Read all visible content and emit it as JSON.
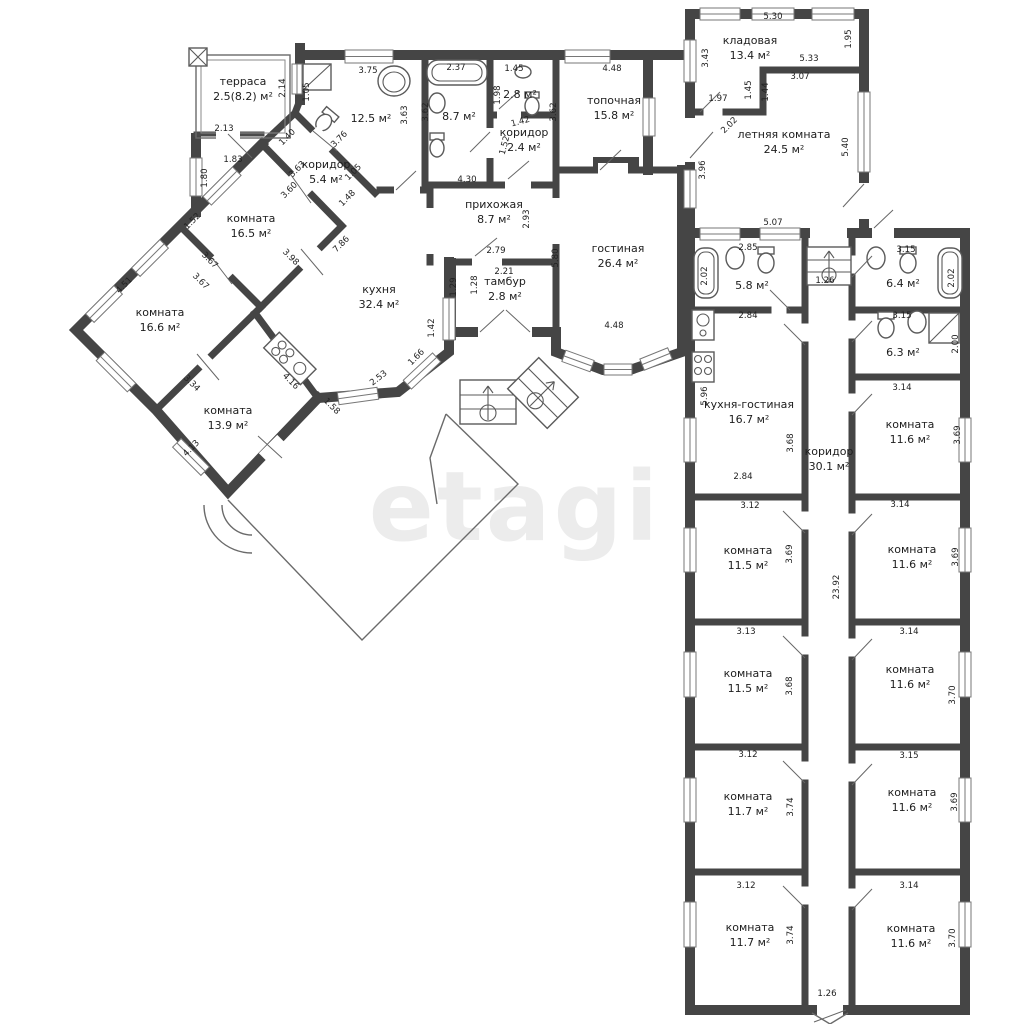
{
  "watermark": "etagi",
  "colors": {
    "wall": "#454545",
    "text": "#1d1d1d",
    "dimension_text": "#222222",
    "watermark": "#ececec",
    "background": "#ffffff"
  },
  "area_unit": "м²",
  "rooms": [
    {
      "name": "терраса",
      "area": "2.5(8.2) м²",
      "x": 243,
      "y": 85
    },
    {
      "name": "коридор",
      "area": "5.4 м²",
      "x": 326,
      "y": 168
    },
    {
      "name": "",
      "area": "12.5 м²",
      "x": 371,
      "y": 116
    },
    {
      "name": "",
      "area": "8.7 м²",
      "x": 459,
      "y": 114
    },
    {
      "name": "",
      "area": "2.8 м²",
      "x": 520,
      "y": 92
    },
    {
      "name": "коридор",
      "area": "2.4 м²",
      "x": 524,
      "y": 136
    },
    {
      "name": "топочная",
      "area": "15.8 м²",
      "x": 614,
      "y": 104
    },
    {
      "name": "прихожая",
      "area": "8.7 м²",
      "x": 494,
      "y": 208
    },
    {
      "name": "тамбур",
      "area": "2.8 м²",
      "x": 505,
      "y": 285
    },
    {
      "name": "гостиная",
      "area": "26.4 м²",
      "x": 618,
      "y": 252
    },
    {
      "name": "кухня",
      "area": "32.4 м²",
      "x": 379,
      "y": 293
    },
    {
      "name": "комната",
      "area": "16.5 м²",
      "x": 251,
      "y": 222
    },
    {
      "name": "комната",
      "area": "16.6 м²",
      "x": 160,
      "y": 316
    },
    {
      "name": "комната",
      "area": "13.9 м²",
      "x": 228,
      "y": 414
    },
    {
      "name": "кладовая",
      "area": "13.4 м²",
      "x": 750,
      "y": 44
    },
    {
      "name": "летняя комната",
      "area": "24.5 м²",
      "x": 784,
      "y": 138
    },
    {
      "name": "",
      "area": "5.8 м²",
      "x": 752,
      "y": 283
    },
    {
      "name": "",
      "area": "6.4 м²",
      "x": 903,
      "y": 281
    },
    {
      "name": "",
      "area": "6.3 м²",
      "x": 903,
      "y": 350
    },
    {
      "name": "кухня-гостиная",
      "area": "16.7 м²",
      "x": 749,
      "y": 408
    },
    {
      "name": "коридор",
      "area": "30.1 м²",
      "x": 829,
      "y": 455
    },
    {
      "name": "комната",
      "area": "11.6 м²",
      "x": 910,
      "y": 428
    },
    {
      "name": "комната",
      "area": "11.5 м²",
      "x": 748,
      "y": 554
    },
    {
      "name": "комната",
      "area": "11.6 м²",
      "x": 912,
      "y": 553
    },
    {
      "name": "комната",
      "area": "11.5 м²",
      "x": 748,
      "y": 677
    },
    {
      "name": "комната",
      "area": "11.6 м²",
      "x": 910,
      "y": 673
    },
    {
      "name": "комната",
      "area": "11.7 м²",
      "x": 748,
      "y": 800
    },
    {
      "name": "комната",
      "area": "11.6 м²",
      "x": 912,
      "y": 796
    },
    {
      "name": "комната",
      "area": "11.7 м²",
      "x": 750,
      "y": 931
    },
    {
      "name": "комната",
      "area": "11.6 м²",
      "x": 911,
      "y": 932
    }
  ],
  "dimensions": [
    {
      "v": "2.13",
      "x": 224,
      "y": 131,
      "r": 0
    },
    {
      "v": "1.83",
      "x": 233,
      "y": 162,
      "r": 0
    },
    {
      "v": "1.80",
      "x": 207,
      "y": 178,
      "r": -90
    },
    {
      "v": "2.14",
      "x": 285,
      "y": 88,
      "r": -90
    },
    {
      "v": "1.05",
      "x": 309,
      "y": 92,
      "r": -90
    },
    {
      "v": "3.75",
      "x": 368,
      "y": 73,
      "r": 0
    },
    {
      "v": "2.37",
      "x": 456,
      "y": 70,
      "r": 0
    },
    {
      "v": "1.45",
      "x": 514,
      "y": 71,
      "r": 0
    },
    {
      "v": "1.98",
      "x": 500,
      "y": 95,
      "r": -90
    },
    {
      "v": "3.63",
      "x": 407,
      "y": 115,
      "r": -90
    },
    {
      "v": "3.62",
      "x": 428,
      "y": 112,
      "r": -90
    },
    {
      "v": "3.62",
      "x": 556,
      "y": 112,
      "r": -90
    },
    {
      "v": "1.42",
      "x": 521,
      "y": 124,
      "r": -15
    },
    {
      "v": "1.52",
      "x": 507,
      "y": 146,
      "r": -75
    },
    {
      "v": "4.48",
      "x": 612,
      "y": 71,
      "r": 0
    },
    {
      "v": "4.30",
      "x": 467,
      "y": 182,
      "r": 0
    },
    {
      "v": "2.93",
      "x": 529,
      "y": 219,
      "r": -90
    },
    {
      "v": "5.80",
      "x": 558,
      "y": 258,
      "r": -90
    },
    {
      "v": "4.48",
      "x": 614,
      "y": 328,
      "r": 0
    },
    {
      "v": "2.79",
      "x": 496,
      "y": 253,
      "r": 0
    },
    {
      "v": "2.21",
      "x": 504,
      "y": 274,
      "r": 0
    },
    {
      "v": "1.29",
      "x": 456,
      "y": 287,
      "r": -90
    },
    {
      "v": "1.28",
      "x": 477,
      "y": 285,
      "r": -90
    },
    {
      "v": "1.42",
      "x": 434,
      "y": 328,
      "r": -90
    },
    {
      "v": "1.66",
      "x": 418,
      "y": 359,
      "r": -45
    },
    {
      "v": "2.53",
      "x": 380,
      "y": 380,
      "r": -38
    },
    {
      "v": "7.86",
      "x": 343,
      "y": 246,
      "r": -45
    },
    {
      "v": "1.48",
      "x": 349,
      "y": 200,
      "r": -45
    },
    {
      "v": "1.40",
      "x": 289,
      "y": 139,
      "r": -45
    },
    {
      "v": "3.63",
      "x": 299,
      "y": 171,
      "r": -45
    },
    {
      "v": "3.60",
      "x": 291,
      "y": 192,
      "r": -45
    },
    {
      "v": "3.76",
      "x": 341,
      "y": 141,
      "r": -45
    },
    {
      "v": "1.05",
      "x": 355,
      "y": 174,
      "r": -45
    },
    {
      "v": "1.52",
      "x": 194,
      "y": 223,
      "r": -45
    },
    {
      "v": "4.51",
      "x": 126,
      "y": 287,
      "r": -45
    },
    {
      "v": "3.67",
      "x": 208,
      "y": 262,
      "r": 45
    },
    {
      "v": "3.67",
      "x": 199,
      "y": 283,
      "r": 45
    },
    {
      "v": "3.98",
      "x": 289,
      "y": 259,
      "r": 45
    },
    {
      "v": "3.34",
      "x": 190,
      "y": 385,
      "r": 45
    },
    {
      "v": "4.13",
      "x": 193,
      "y": 450,
      "r": -45
    },
    {
      "v": "4.16",
      "x": 289,
      "y": 383,
      "r": 45
    },
    {
      "v": "1.58",
      "x": 330,
      "y": 408,
      "r": 45
    },
    {
      "v": "5.30",
      "x": 773,
      "y": 19,
      "r": 0
    },
    {
      "v": "1.95",
      "x": 851,
      "y": 39,
      "r": -90
    },
    {
      "v": "3.43",
      "x": 708,
      "y": 58,
      "r": -90
    },
    {
      "v": "5.33",
      "x": 809,
      "y": 61,
      "r": 0
    },
    {
      "v": "3.07",
      "x": 800,
      "y": 79,
      "r": 0
    },
    {
      "v": "1.45",
      "x": 751,
      "y": 90,
      "r": -90
    },
    {
      "v": "1.44",
      "x": 768,
      "y": 92,
      "r": -90
    },
    {
      "v": "1.97",
      "x": 718,
      "y": 101,
      "r": 0
    },
    {
      "v": "2.02",
      "x": 731,
      "y": 127,
      "r": -45
    },
    {
      "v": "5.40",
      "x": 848,
      "y": 147,
      "r": -90
    },
    {
      "v": "3.96",
      "x": 705,
      "y": 170,
      "r": -90
    },
    {
      "v": "5.07",
      "x": 773,
      "y": 225,
      "r": 0
    },
    {
      "v": "2.85",
      "x": 748,
      "y": 250,
      "r": 0
    },
    {
      "v": "2.02",
      "x": 707,
      "y": 276,
      "r": -90
    },
    {
      "v": "3.15",
      "x": 906,
      "y": 252,
      "r": 0
    },
    {
      "v": "2.02",
      "x": 954,
      "y": 278,
      "r": -90
    },
    {
      "v": "1.26",
      "x": 825,
      "y": 283,
      "r": 0
    },
    {
      "v": "2.84",
      "x": 748,
      "y": 318,
      "r": 0
    },
    {
      "v": "3.15",
      "x": 902,
      "y": 318,
      "r": 0
    },
    {
      "v": "2.00",
      "x": 958,
      "y": 344,
      "r": -90
    },
    {
      "v": "5.96",
      "x": 707,
      "y": 396,
      "r": -90
    },
    {
      "v": "3.68",
      "x": 793,
      "y": 443,
      "r": -90
    },
    {
      "v": "2.84",
      "x": 743,
      "y": 479,
      "r": 0
    },
    {
      "v": "3.14",
      "x": 902,
      "y": 390,
      "r": 0
    },
    {
      "v": "3.69",
      "x": 960,
      "y": 435,
      "r": -90
    },
    {
      "v": "3.12",
      "x": 750,
      "y": 508,
      "r": 0
    },
    {
      "v": "3.69",
      "x": 792,
      "y": 554,
      "r": -90
    },
    {
      "v": "3.14",
      "x": 900,
      "y": 507,
      "r": 0
    },
    {
      "v": "3.69",
      "x": 958,
      "y": 557,
      "r": -90
    },
    {
      "v": "23.92",
      "x": 839,
      "y": 587,
      "r": -90
    },
    {
      "v": "3.13",
      "x": 746,
      "y": 634,
      "r": 0
    },
    {
      "v": "3.68",
      "x": 792,
      "y": 686,
      "r": -90
    },
    {
      "v": "3.14",
      "x": 909,
      "y": 634,
      "r": 0
    },
    {
      "v": "3.70",
      "x": 955,
      "y": 695,
      "r": -90
    },
    {
      "v": "3.12",
      "x": 748,
      "y": 757,
      "r": 0
    },
    {
      "v": "3.74",
      "x": 793,
      "y": 807,
      "r": -90
    },
    {
      "v": "3.15",
      "x": 909,
      "y": 758,
      "r": 0
    },
    {
      "v": "3.69",
      "x": 957,
      "y": 802,
      "r": -90
    },
    {
      "v": "3.12",
      "x": 746,
      "y": 888,
      "r": 0
    },
    {
      "v": "3.74",
      "x": 793,
      "y": 935,
      "r": -90
    },
    {
      "v": "3.14",
      "x": 909,
      "y": 888,
      "r": 0
    },
    {
      "v": "3.70",
      "x": 955,
      "y": 938,
      "r": -90
    },
    {
      "v": "1.26",
      "x": 827,
      "y": 996,
      "r": 0
    }
  ]
}
